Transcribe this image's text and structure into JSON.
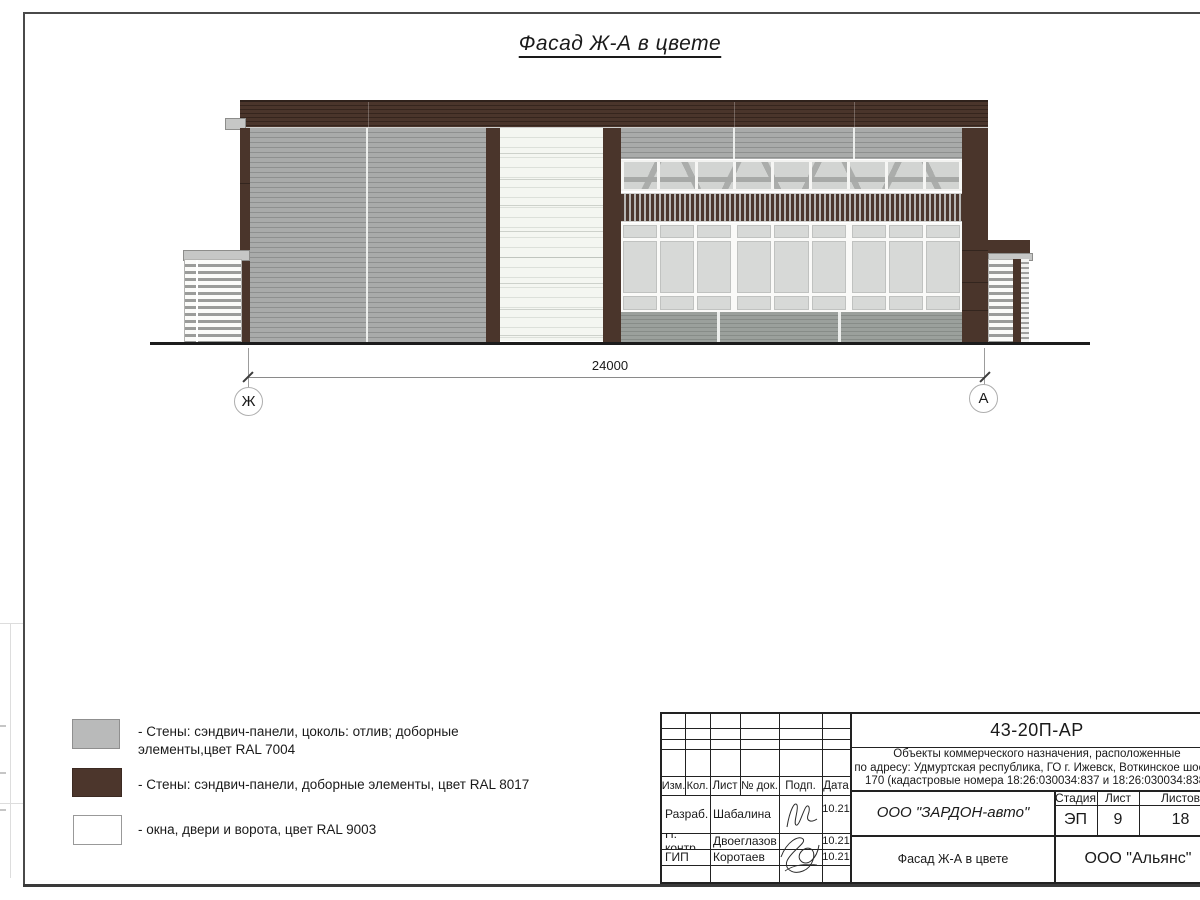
{
  "sheet": {
    "title": "Фасад Ж-А в цвете",
    "dimension_label": "24000",
    "axis_left": "Ж",
    "axis_right": "А"
  },
  "colors": {
    "wall_gray_ral7004": "#a9abaa",
    "brown_ral8017": "#4a352b",
    "white_ral9003": "#f4f6f1",
    "base_gray": "#9ba09c",
    "glass": "#d7d9d7"
  },
  "legend": {
    "items": [
      {
        "color": "#b9baba",
        "label": "- Стены: сэндвич-панели, цоколь: отлив; доборные\nэлементы,цвет RAL 7004"
      },
      {
        "color": "#4c362c",
        "label": "- Стены: сэндвич-панели, доборные элементы, цвет RAL 8017"
      },
      {
        "color": "#ffffff",
        "label": "- окна, двери и ворота, цвет RAL 9003"
      }
    ]
  },
  "titleblock": {
    "doc_number": "43-20П-АР",
    "description_line1": "Объекты коммерческого назначения, расположенные",
    "description_line2": "по адресу: Удмуртская республика, ГО г. Ижевск, Воткинское шоссе,",
    "description_line3": "170 (кадастровые номера 18:26:030034:837 и 18:26:030034:838)",
    "col_headers": [
      "Изм.",
      "Кол.",
      "Лист",
      "№ док.",
      "Подп.",
      "Дата"
    ],
    "rows": [
      {
        "role": "Разраб.",
        "name": "Шабалина",
        "date": "10.21"
      },
      {
        "role": "Н. контр.",
        "name": "Двоеглазов",
        "date": "10.21"
      },
      {
        "role": "ГИП",
        "name": "Коротаев",
        "date": "10.21"
      }
    ],
    "company": "ООО \"ЗАРДОН-авто\"",
    "stage_headers": [
      "Стадия",
      "Лист",
      "Листов"
    ],
    "stage_value": "ЭП",
    "sheet_number": "9",
    "sheets_total": "18",
    "drawing_name": "Фасад Ж-А в цвете",
    "firm": "ООО \"Альянс\""
  },
  "building": {
    "clerestory_count": 9,
    "window_count": 9,
    "window_groups_extra_gap_after": [
      3,
      6
    ]
  }
}
